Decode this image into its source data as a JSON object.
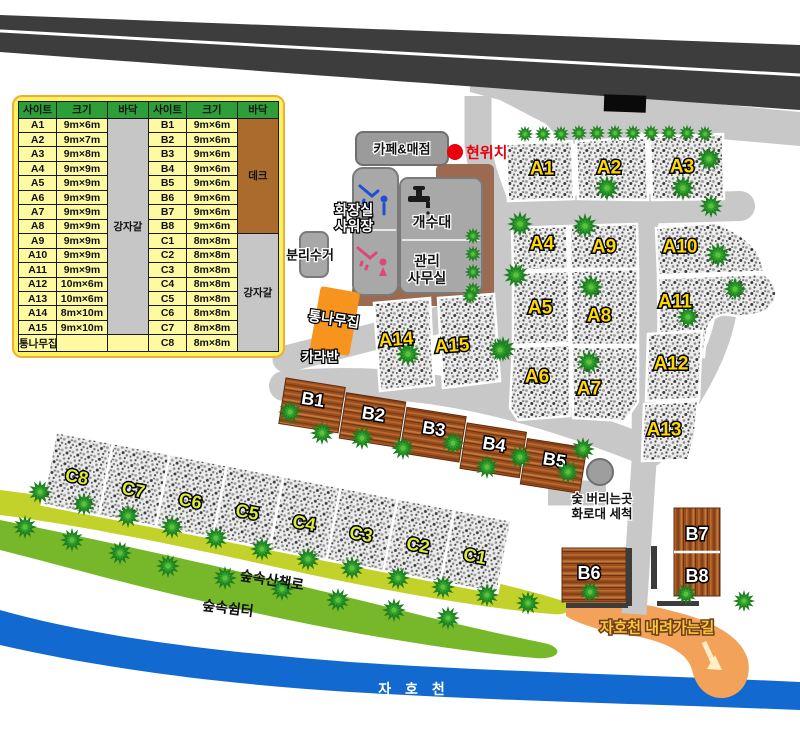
{
  "legend_table": {
    "headers": [
      "사이트",
      "크기",
      "바닥",
      "사이트",
      "크기",
      "바닥"
    ],
    "floor_a": "강자갈",
    "floor_b": "데크",
    "floor_c": "강자갈",
    "rows": [
      {
        "s1": "A1",
        "z1": "9m×6m",
        "s2": "B1",
        "z2": "9m×6m"
      },
      {
        "s1": "A2",
        "z1": "9m×7m",
        "s2": "B2",
        "z2": "9m×6m"
      },
      {
        "s1": "A3",
        "z1": "9m×8m",
        "s2": "B3",
        "z2": "9m×6m"
      },
      {
        "s1": "A4",
        "z1": "9m×9m",
        "s2": "B4",
        "z2": "9m×6m"
      },
      {
        "s1": "A5",
        "z1": "9m×9m",
        "s2": "B5",
        "z2": "9m×6m"
      },
      {
        "s1": "A6",
        "z1": "9m×9m",
        "s2": "B6",
        "z2": "9m×6m"
      },
      {
        "s1": "A7",
        "z1": "9m×9m",
        "s2": "B7",
        "z2": "9m×6m"
      },
      {
        "s1": "A8",
        "z1": "9m×9m",
        "s2": "B8",
        "z2": "9m×6m"
      },
      {
        "s1": "A9",
        "z1": "9m×9m",
        "s2": "C1",
        "z2": "8m×8m"
      },
      {
        "s1": "A10",
        "z1": "9m×9m",
        "s2": "C2",
        "z2": "8m×8m"
      },
      {
        "s1": "A11",
        "z1": "9m×9m",
        "s2": "C3",
        "z2": "8m×8m"
      },
      {
        "s1": "A12",
        "z1": "10m×6m",
        "s2": "C4",
        "z2": "8m×8m"
      },
      {
        "s1": "A13",
        "z1": "10m×6m",
        "s2": "C5",
        "z2": "8m×8m"
      },
      {
        "s1": "A14",
        "z1": "8m×10m",
        "s2": "C6",
        "z2": "8m×8m"
      },
      {
        "s1": "A15",
        "z1": "9m×10m",
        "s2": "C7",
        "z2": "8m×8m"
      },
      {
        "s1": "통나무집",
        "z1": "",
        "s2": "C8",
        "z2": "8m×8m"
      }
    ]
  },
  "map": {
    "site_labels": {
      "A1": "A1",
      "A2": "A2",
      "A3": "A3",
      "A4": "A4",
      "A5": "A5",
      "A6": "A6",
      "A7": "A7",
      "A8": "A8",
      "A9": "A9",
      "A10": "A10",
      "A11": "A11",
      "A12": "A12",
      "A13": "A13",
      "A14": "A14",
      "A15": "A15",
      "B1": "B1",
      "B2": "B2",
      "B3": "B3",
      "B4": "B4",
      "B5": "B5",
      "B6": "B6",
      "B7": "B7",
      "B8": "B8",
      "C1": "C1",
      "C2": "C2",
      "C3": "C3",
      "C4": "C4",
      "C5": "C5",
      "C6": "C6",
      "C7": "C7",
      "C8": "C8"
    },
    "buildings": {
      "cafe": "카페&매점",
      "toilet_line1": "화장실",
      "toilet_line2": "샤워장",
      "sink": "개수대",
      "office_line1": "관리",
      "office_line2": "사무실",
      "recycle": "분리수거",
      "cabin": "통나무집",
      "caravan": "카라반"
    },
    "poi": {
      "current_location": "현위치",
      "charcoal_line1": "숯 버리는곳",
      "charcoal_line2": "화로대 세척",
      "river_path": "자호천 내려가는길",
      "trail": "숲속산책로",
      "rest_area": "숲속쉼터",
      "river": "자 호 천"
    }
  },
  "colors": {
    "accent_red": "#e8000d",
    "deck_brown": "#9b6a50",
    "cabin_orange": "#f7941d",
    "river_blue": "#1269cf",
    "trail_green": "#c3d22b",
    "forest_green": "#76b82a",
    "path_orange": "#f2a259",
    "road_gray": "#c8c8c8",
    "asphalt": "#3d3d3d"
  }
}
